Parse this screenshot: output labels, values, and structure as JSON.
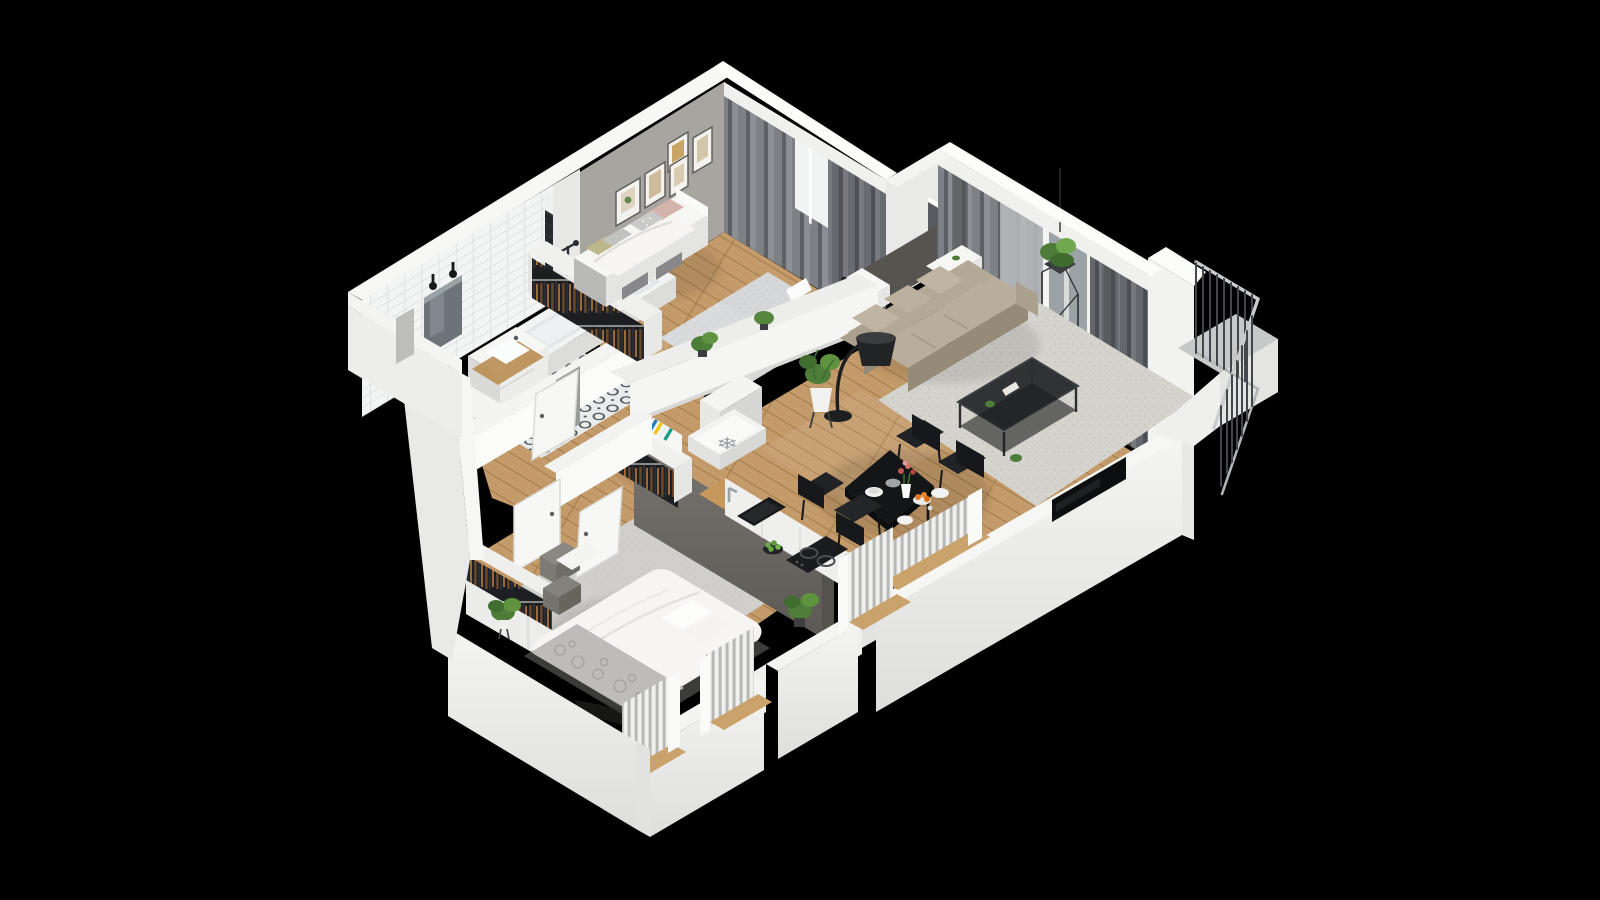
{
  "scene": {
    "description": "3D isometric cutaway render of a one-bedroom-plus-kids-room apartment floor plan on a black background",
    "projection": "isometric",
    "background": "#000000"
  },
  "icons": {
    "fridge_snowflake": "❄"
  },
  "rooms": [
    {
      "name": "bathroom",
      "floor": "ornament-tile",
      "items": [
        "washing-machine",
        "vanity-with-sink",
        "wood-shelf",
        "mirror",
        "wall-sconces",
        "bathtub",
        "shower-fixture",
        "black-tile-wall",
        "white-tile-wall",
        "door-ajar"
      ]
    },
    {
      "name": "kids-bedroom",
      "floor": "wood",
      "items": [
        "daybed",
        "pink-pillow",
        "dotted-pillow",
        "olive-pillow",
        "under-bed-storage",
        "gallery-wall-frames",
        "open-wardrobe-with-clothes",
        "area-rug",
        "desk",
        "desk-chair",
        "desk-lamp",
        "parrot-figurine",
        "curtain-wall",
        "window"
      ]
    },
    {
      "name": "hallway",
      "floor": "wood",
      "items": [
        "entry-door",
        "open-wardrobe-with-clothes",
        "bookshelf-with-books",
        "fridge-top-with-snowflake",
        "tall-cabinet",
        "interior-doors"
      ]
    },
    {
      "name": "kitchen",
      "floor": "wood",
      "items": [
        "wood-countertop",
        "sink",
        "faucet",
        "induction-cooktop",
        "fruit-bowl-green-apples",
        "window-with-radiator",
        "potted-plant"
      ]
    },
    {
      "name": "living-dining-room",
      "floor": "wood-and-carpet",
      "items": [
        "beige-sofa",
        "arc-floor-lamp",
        "black-coffee-table",
        "area-rug",
        "wall-tv",
        "white-console",
        "hanging-plant",
        "potted-plant",
        "dining-table",
        "four-black-chairs",
        "plates",
        "flower-vase",
        "orange-fruit-bowl",
        "curtain-window-wall",
        "balcony-door",
        "dining-window-with-radiator"
      ]
    },
    {
      "name": "master-bedroom",
      "floor": "wood-and-rug",
      "items": [
        "double-bed",
        "white-duvet",
        "patterned-throw",
        "pillows",
        "open-wardrobe-with-clothes",
        "storage-boxes",
        "potted-plant",
        "two-windows-with-radiators",
        "door-ajar"
      ]
    },
    {
      "name": "balcony",
      "items": [
        "metal-railing",
        "concrete-floor",
        "white-slab"
      ]
    }
  ],
  "colors": {
    "background": "#000000",
    "wall_white": "#f1f1ef",
    "wall_bright": "#fafaf8",
    "wall_shade": "#e3e3e1",
    "wall_dim": "#d2d2d0",
    "slab": "#ebebe9",
    "accent_wall": "#a8a5a1",
    "partition_dark": "#6e6a66",
    "partition_top": "#8b8783",
    "black_tile": "#24272b",
    "tile_floor": "#eaebec",
    "wood": "#c49b6a",
    "wood_dark": "#a87f4f",
    "counter_wood": "#c6985e",
    "carpet": "#d5d3cd",
    "rug_kid": "#d6d7d9",
    "rug_master": "#d0cfcb",
    "curtain": "#74777b",
    "curtain_sheer": "#b7bbbd",
    "glass": "#9ba3a7",
    "sofa": "#b4a996",
    "sofa_shade": "#958b78",
    "furniture_black": "#1d1f21",
    "bed_white": "#f6f5f2",
    "throw_gray": "#bdbcba",
    "plant_green": "#4e7d3a",
    "plant_light": "#6fa84e",
    "orange_fruit": "#e0791f",
    "pillow_pink": "#d5b3ad",
    "pillow_olive": "#bcb88c",
    "rail_metal": "#43464a",
    "rail_light": "#c9cbcd"
  }
}
